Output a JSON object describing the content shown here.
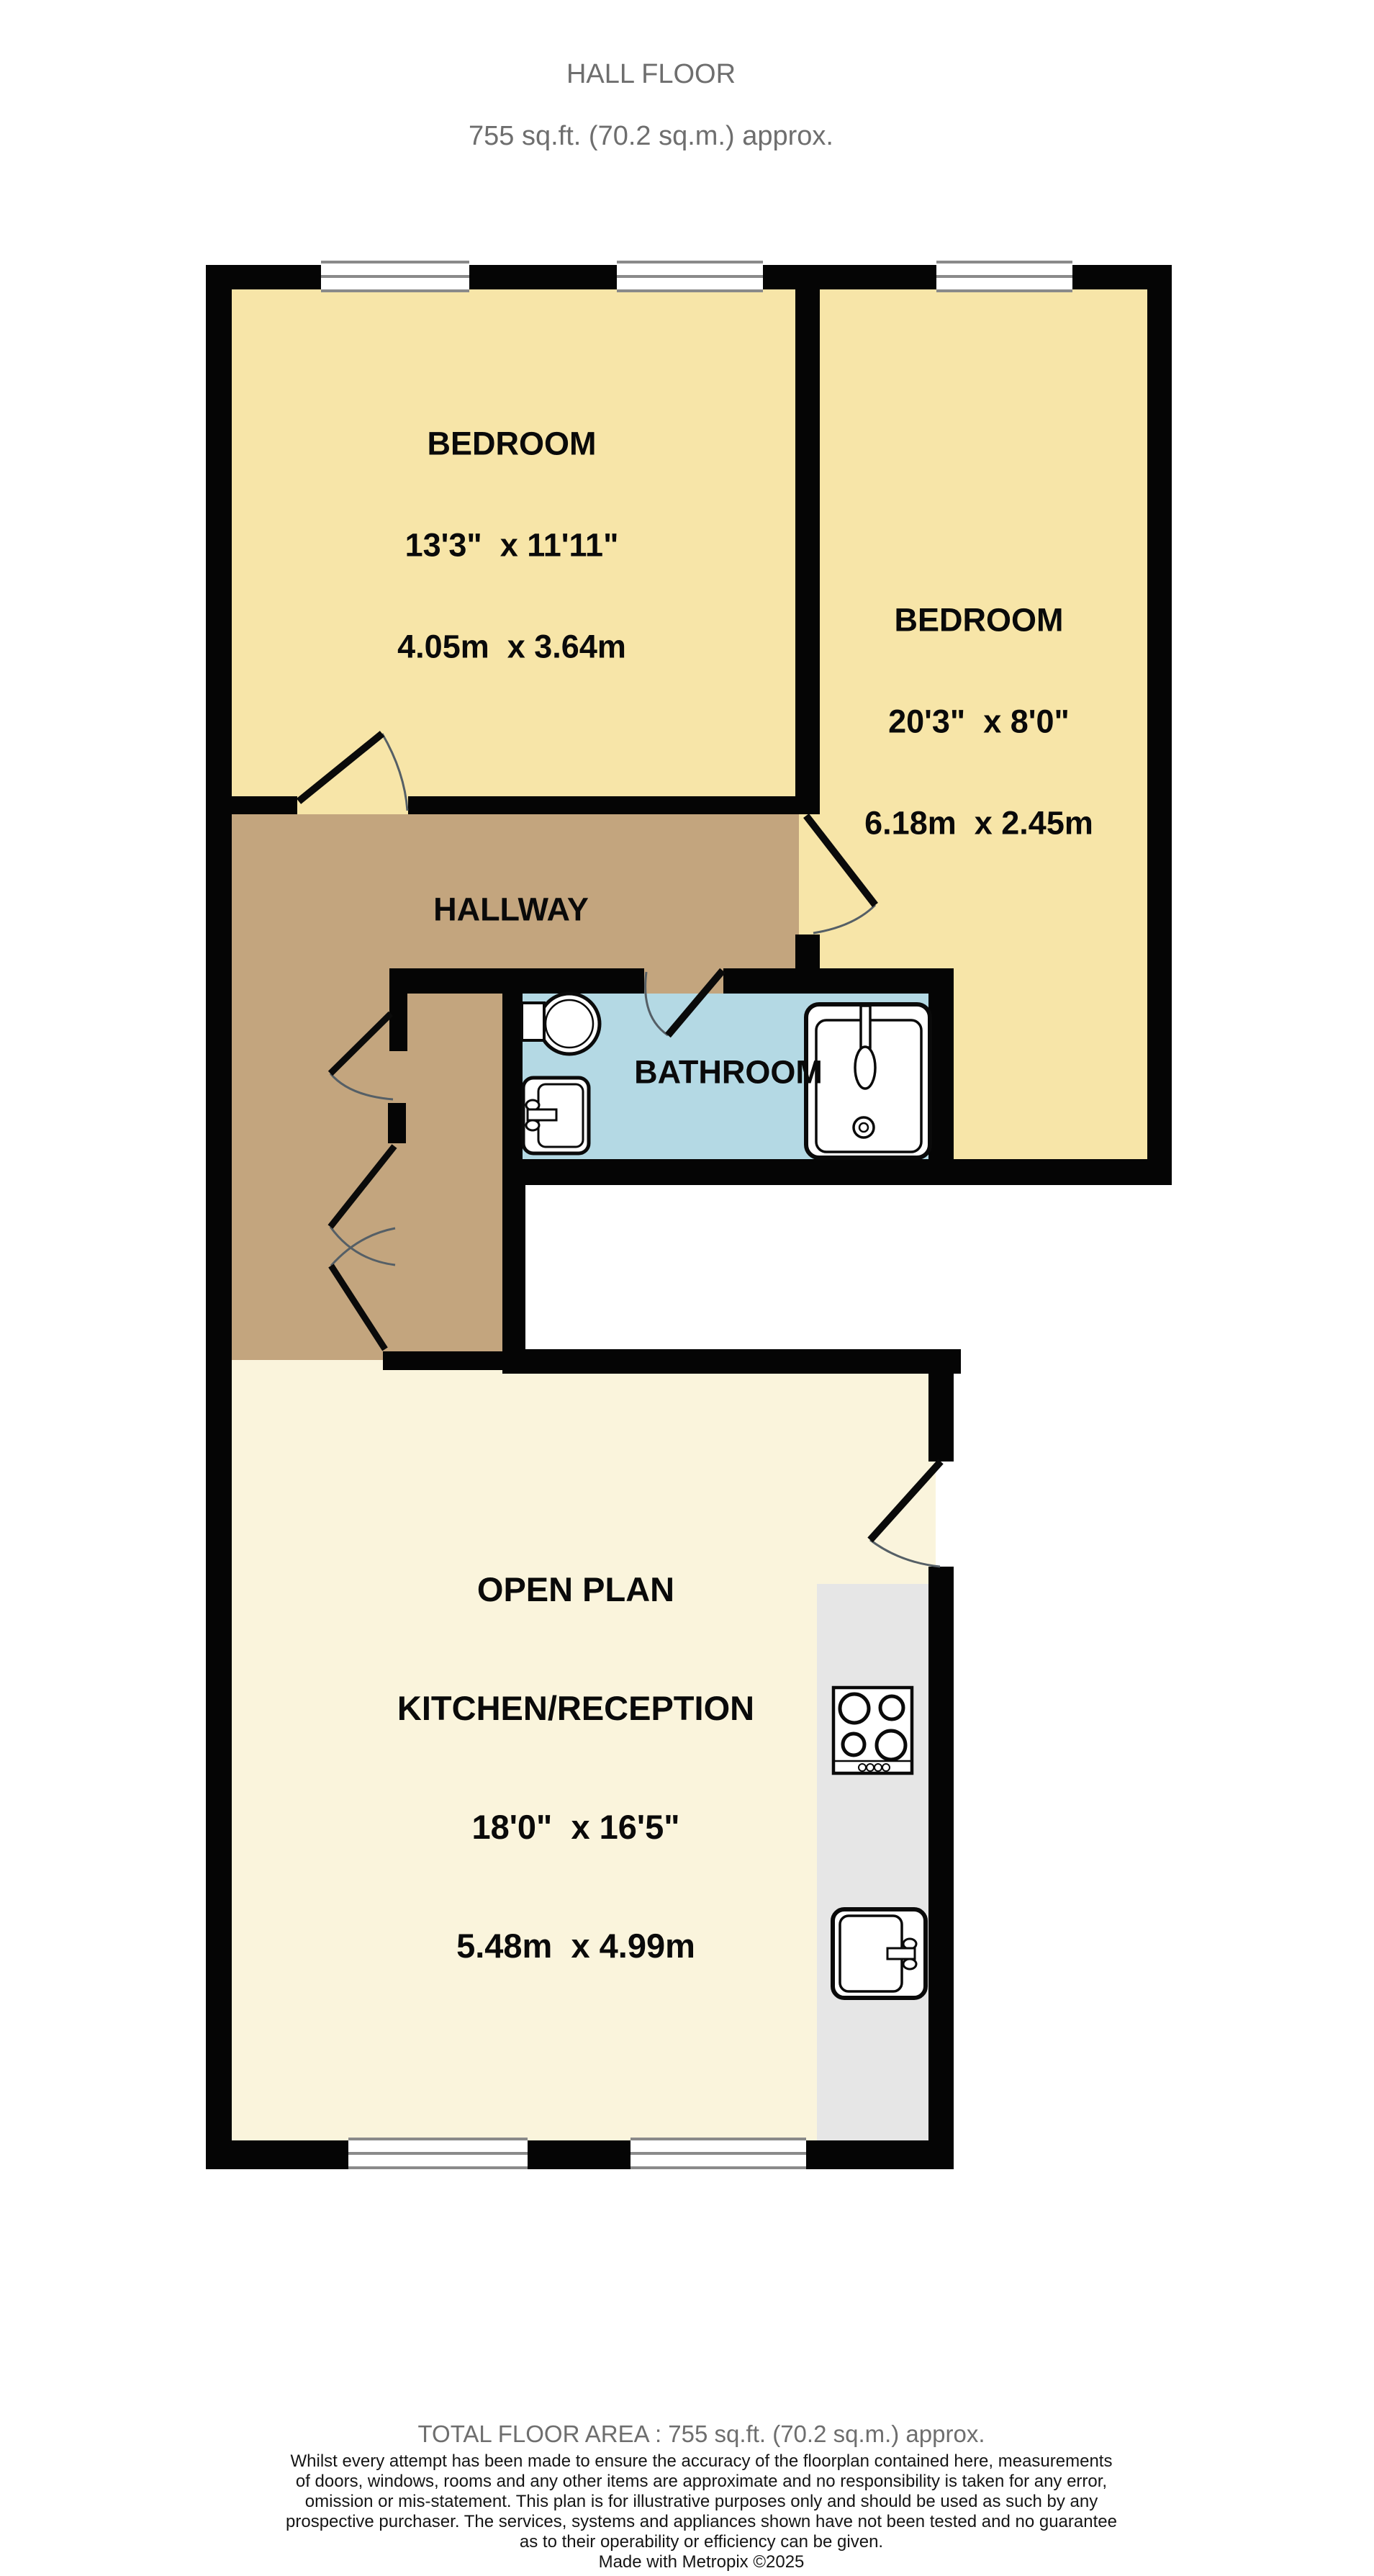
{
  "title": {
    "line1": "HALL FLOOR",
    "line2": "755 sq.ft. (70.2 sq.m.) approx."
  },
  "rooms": {
    "bedroom1": {
      "name": "BEDROOM",
      "imperial": "13'3\"  x 11'11\"",
      "metric": "4.05m  x 3.64m"
    },
    "bedroom2": {
      "name": "BEDROOM",
      "imperial": "20'3\"  x 8'0\"",
      "metric": "6.18m  x 2.45m"
    },
    "hallway": {
      "name": "HALLWAY"
    },
    "bathroom": {
      "name": "BATHROOM"
    },
    "open_plan": {
      "name_line1": "OPEN PLAN",
      "name_line2": "KITCHEN/RECEPTION",
      "imperial": "18'0\"  x 16'5\"",
      "metric": "5.48m  x 4.99m"
    }
  },
  "footer": {
    "total_area": "TOTAL FLOOR AREA : 755 sq.ft. (70.2 sq.m.) approx.",
    "disclaimer_lines": [
      "Whilst every attempt has been made to ensure the accuracy of the floorplan contained here, measurements",
      "of doors, windows, rooms and any other items are approximate and no responsibility is taken for any error,",
      "omission or mis-statement. This plan is for illustrative purposes only and should be used as such by any",
      "prospective purchaser. The services, systems and appliances shown have not been tested and no guarantee",
      "as to their operability or efficiency can be given."
    ],
    "credit": "Made with Metropix ©2025"
  },
  "colors": {
    "wall": "#050505",
    "bedroom_fill": "#F7E5A8",
    "hallway_fill": "#C3A57E",
    "bathroom_fill": "#B4D9E4",
    "open_plan_fill": "#FAF4DC",
    "counter_fill": "#E6E6E6",
    "window_frame": "#8A8A8A",
    "muted_text": "#6E6E6E"
  }
}
